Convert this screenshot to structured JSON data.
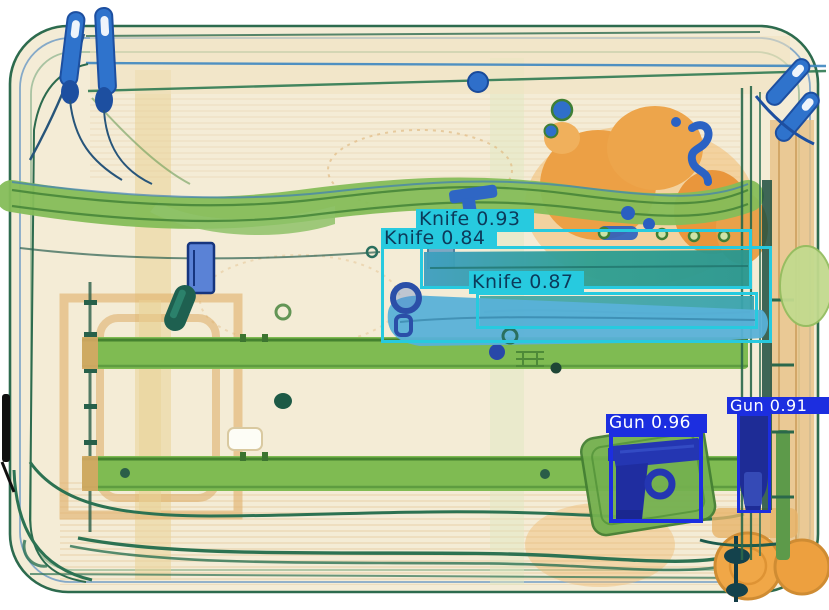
{
  "scene": {
    "kind": "xray-baggage-scan",
    "background_color": "#ffffff",
    "palette": {
      "case_fill": "#f4ecd6",
      "case_outline": "#2d6b4e",
      "organic_orange": "#eca045",
      "metal_green_band": "#83bd58",
      "rail_green": "#7fbb52",
      "knife_teal": "#2f9f92",
      "knife_blue": "#58b1d8",
      "gun_navy": "#2130ab",
      "hardware_blue": "#2f73cc"
    }
  },
  "detections": [
    {
      "id": "knife-093",
      "label": "Knife",
      "score": 0.93,
      "display": "Knife 0.93",
      "box": {
        "x": 420,
        "y": 229,
        "w": 332,
        "h": 60
      },
      "label_box": {
        "x": 416,
        "y": 209,
        "w": 118,
        "h": 20,
        "font": 19
      },
      "box_color": "#27cadf",
      "label_bg": "#27cadf",
      "text_color": "#0c3a5a",
      "stroke": 3
    },
    {
      "id": "knife-084",
      "label": "Knife",
      "score": 0.84,
      "display": "Knife 0.84",
      "box": {
        "x": 381,
        "y": 246,
        "w": 391,
        "h": 97
      },
      "label_box": {
        "x": 381,
        "y": 228,
        "w": 116,
        "h": 20,
        "font": 19
      },
      "box_color": "#27cadf",
      "label_bg": "#27cadf",
      "text_color": "#0c3a5a",
      "stroke": 3
    },
    {
      "id": "knife-087",
      "label": "Knife",
      "score": 0.87,
      "display": "Knife 0.87",
      "box": {
        "x": 476,
        "y": 292,
        "w": 282,
        "h": 37
      },
      "label_box": {
        "x": 469,
        "y": 271,
        "w": 115,
        "h": 23,
        "font": 19
      },
      "box_color": "#27cadf",
      "label_bg": "#27cadf",
      "text_color": "#0c3a5a",
      "stroke": 3
    },
    {
      "id": "gun-096",
      "label": "Gun",
      "score": 0.96,
      "display": "Gun 0.96",
      "box": {
        "x": 609,
        "y": 433,
        "w": 94,
        "h": 90
      },
      "label_box": {
        "x": 606,
        "y": 414,
        "w": 101,
        "h": 19,
        "font": 17
      },
      "box_color": "#1c2ee0",
      "label_bg": "#1c2ee0",
      "text_color": "#ffffff",
      "stroke": 4
    },
    {
      "id": "gun-091",
      "label": "Gun",
      "score": 0.91,
      "display": "Gun 0.91",
      "box": {
        "x": 737,
        "y": 413,
        "w": 34,
        "h": 100
      },
      "label_box": {
        "x": 727,
        "y": 397,
        "w": 102,
        "h": 17,
        "font": 16
      },
      "box_color": "#1c2ee0",
      "label_bg": "#1c2ee0",
      "text_color": "#ffffff",
      "stroke": 3
    }
  ]
}
